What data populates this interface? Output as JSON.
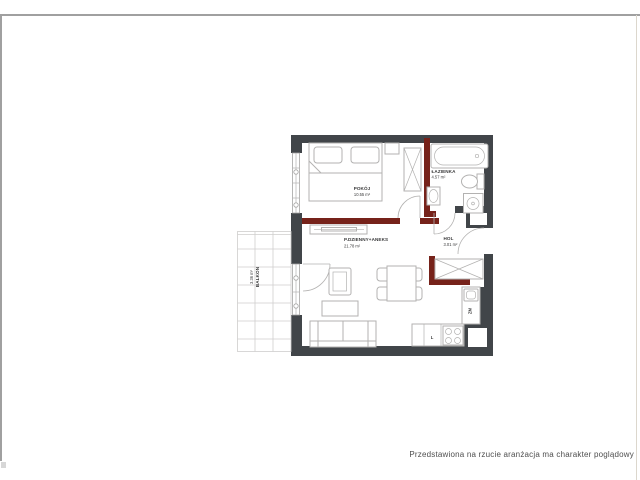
{
  "frame": {
    "disclaimer": "Przedstawiona na rzucie aranżacja ma charakter poglądowy"
  },
  "floorplan": {
    "rooms": [
      {
        "name": "POKÓJ",
        "area": "10.55 m²"
      },
      {
        "name": "P.DZIENNY+ANEKS",
        "area": "21.78 m²"
      },
      {
        "name": "ŁAZIENKA",
        "area": "4.57 m²"
      },
      {
        "name": "HOL",
        "area": "3.01 m²"
      },
      {
        "name": "BALKON",
        "area": "3.36 m²"
      }
    ],
    "appliances": {
      "fridge_label": "L",
      "dishwasher_label": "ZM"
    },
    "colors": {
      "wall": "#414549",
      "accent": "#76221a",
      "furniture": "#b3b2b1",
      "grid": "#cfcecd",
      "window": "#a5a4a3",
      "label": "#39393a",
      "disclaimer": "#4e4e4e",
      "frame": "#a0a0a0"
    }
  }
}
